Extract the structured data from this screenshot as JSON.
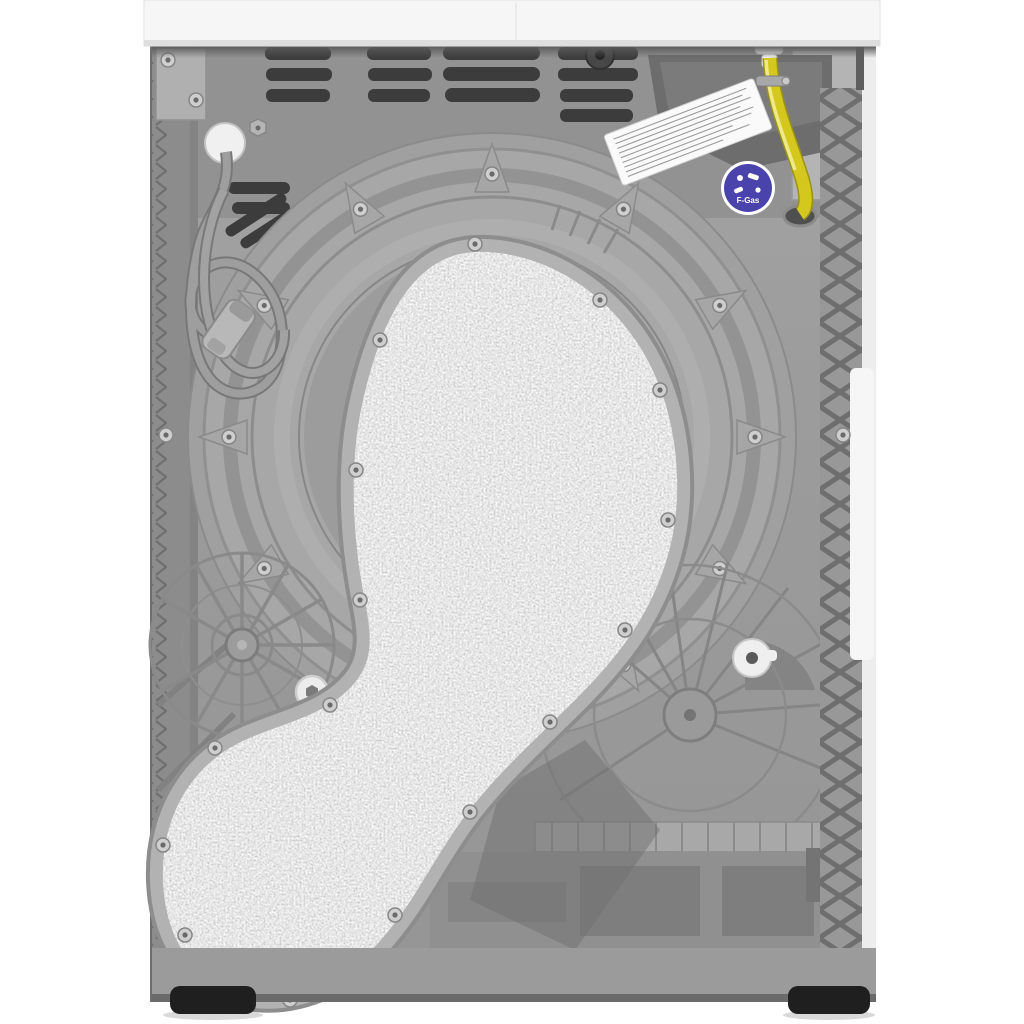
{
  "scene": {
    "type": "product-photo",
    "description": "Rear view of a white heat-pump tumble dryer: grey back panel with vent slots, large round drum cover, grey felt-covered condenser duct, coiled power cord with plug, yellow drain hose, white warning label with blue F-Gas badge, ribbed plastic base and black feet",
    "background": "#ffffff"
  },
  "colors": {
    "worktop": "#f6f6f6",
    "panel": "#9c9c9c",
    "panel_dark": "#909090",
    "plastic": "#a7a7a7",
    "slot": "#3a3a3a",
    "felt": "#d6d6d6",
    "rim": "#b2b2b2",
    "cord": "#9e9e9e",
    "hose": "#d4c81e",
    "hose_highlight": "#efe98a",
    "fgas_blue": "#4a43ab",
    "label_white": "#fafafa",
    "tank_dark": "#6d6d6d",
    "lattice": "#6e6e6e",
    "foot": "#1f1f1f"
  },
  "labels": {
    "fgas_badge_text": "F-Gas"
  }
}
